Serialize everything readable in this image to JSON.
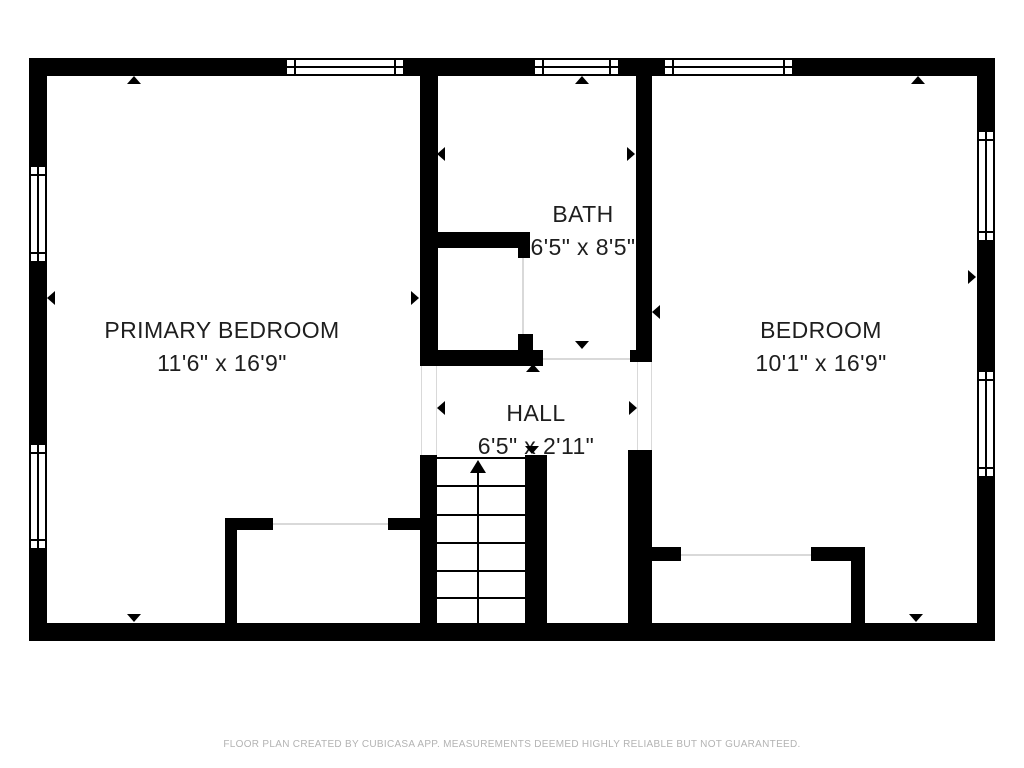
{
  "rooms": [
    {
      "id": "primary-bedroom",
      "name": "PRIMARY BEDROOM",
      "dimensions": "11'6\" x 16'9\""
    },
    {
      "id": "bath",
      "name": "BATH",
      "dimensions": "6'5\" x 8'5\""
    },
    {
      "id": "bedroom",
      "name": "BEDROOM",
      "dimensions": "10'1\" x 16'9\""
    },
    {
      "id": "hall",
      "name": "HALL",
      "dimensions": "6'5\" x 2'11\""
    }
  ],
  "stairs": {
    "direction": "up"
  },
  "footer": {
    "disclaimer": "FLOOR PLAN CREATED BY CUBICASA APP. MEASUREMENTS DEEMED HIGHLY RELIABLE BUT NOT GUARANTEED."
  },
  "colors": {
    "wall": "#000000",
    "floor": "#ffffff",
    "label_text": "#1e1e1e",
    "footer_text": "#b3b3b3",
    "opening_line": "#d9d9d9"
  }
}
